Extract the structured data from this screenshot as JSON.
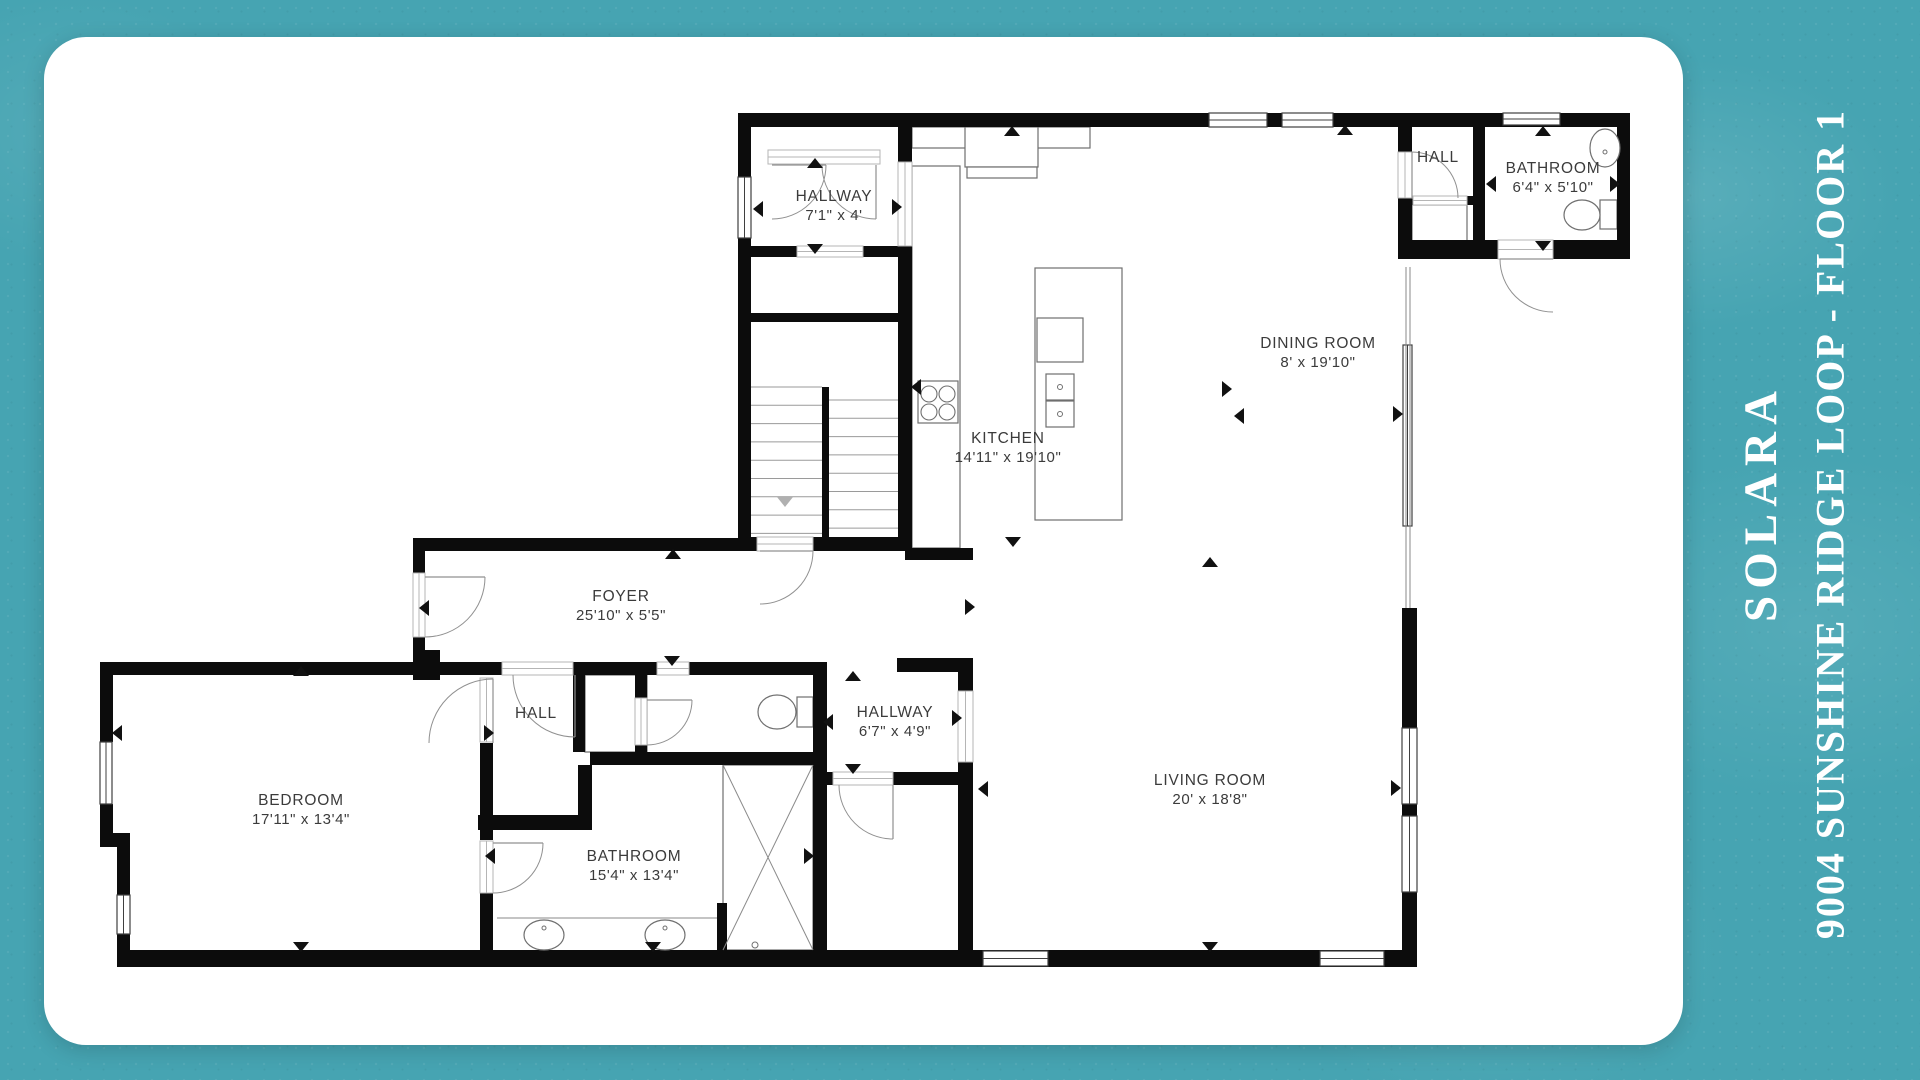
{
  "side_panel": {
    "title": "SOLARA",
    "subtitle": "9004 SUNSHINE RIDGE LOOP  - FLOOR 1"
  },
  "colors": {
    "background_teal": "#46a4b2",
    "card_white": "#ffffff",
    "wall_black": "#0c0c0c",
    "label_gray": "#3b3b3b",
    "title_white": "#ffffff"
  },
  "floor_plan": {
    "rooms": [
      {
        "id": "hallway-upper",
        "name": "HALLWAY",
        "dims": "7'1\" x 4'",
        "x": 834,
        "y": 201
      },
      {
        "id": "kitchen",
        "name": "KITCHEN",
        "dims": "14'11\" x 19'10\"",
        "x": 1008,
        "y": 443
      },
      {
        "id": "dining-room",
        "name": "DINING ROOM",
        "dims": "8' x 19'10\"",
        "x": 1318,
        "y": 348
      },
      {
        "id": "hall-top-right",
        "name": "HALL",
        "dims": "",
        "x": 1438,
        "y": 162
      },
      {
        "id": "bathroom-top-right",
        "name": "BATHROOM",
        "dims": "6'4\" x 5'10\"",
        "x": 1553,
        "y": 173
      },
      {
        "id": "foyer",
        "name": "FOYER",
        "dims": "25'10\" x 5'5\"",
        "x": 621,
        "y": 601
      },
      {
        "id": "bedroom",
        "name": "BEDROOM",
        "dims": "17'11\" x 13'4\"",
        "x": 301,
        "y": 805
      },
      {
        "id": "hall-lower",
        "name": "HALL",
        "dims": "",
        "x": 536,
        "y": 718
      },
      {
        "id": "bathroom-lower",
        "name": "BATHROOM",
        "dims": "15'4\" x 13'4\"",
        "x": 634,
        "y": 861
      },
      {
        "id": "hallway-lower",
        "name": "HALLWAY",
        "dims": "6'7\" x 4'9\"",
        "x": 895,
        "y": 717
      },
      {
        "id": "living-room",
        "name": "LIVING ROOM",
        "dims": "20' x 18'8\"",
        "x": 1210,
        "y": 785
      }
    ],
    "walls": [
      [
        738,
        113,
        892,
        14
      ],
      [
        738,
        127,
        13,
        420
      ],
      [
        898,
        127,
        14,
        35
      ],
      [
        898,
        246,
        14,
        302
      ],
      [
        738,
        246,
        174,
        11
      ],
      [
        750,
        313,
        153,
        9
      ],
      [
        738,
        537,
        174,
        14
      ],
      [
        905,
        548,
        68,
        12
      ],
      [
        413,
        538,
        340,
        13
      ],
      [
        413,
        551,
        12,
        111
      ],
      [
        413,
        650,
        27,
        30
      ],
      [
        1398,
        127,
        14,
        120
      ],
      [
        1473,
        127,
        12,
        116
      ],
      [
        1398,
        196,
        75,
        9
      ],
      [
        1617,
        127,
        13,
        120
      ],
      [
        1398,
        240,
        232,
        19
      ],
      [
        1402,
        608,
        15,
        120
      ],
      [
        1402,
        804,
        15,
        12
      ],
      [
        1402,
        892,
        15,
        75
      ],
      [
        117,
        950,
        1300,
        17
      ],
      [
        100,
        662,
        317,
        13
      ],
      [
        100,
        675,
        13,
        67
      ],
      [
        100,
        804,
        13,
        43
      ],
      [
        100,
        833,
        30,
        14
      ],
      [
        117,
        847,
        13,
        48
      ],
      [
        117,
        934,
        13,
        29
      ],
      [
        480,
        743,
        13,
        97
      ],
      [
        480,
        893,
        13,
        57
      ],
      [
        425,
        662,
        77,
        13
      ],
      [
        573,
        662,
        84,
        13
      ],
      [
        689,
        662,
        138,
        13
      ],
      [
        897,
        658,
        76,
        14
      ],
      [
        573,
        675,
        12,
        77
      ],
      [
        635,
        675,
        12,
        77
      ],
      [
        590,
        752,
        237,
        13
      ],
      [
        578,
        765,
        14,
        65
      ],
      [
        478,
        815,
        114,
        15
      ],
      [
        813,
        663,
        14,
        287
      ],
      [
        827,
        772,
        131,
        13
      ],
      [
        958,
        658,
        15,
        292
      ],
      [
        717,
        903,
        10,
        47
      ]
    ],
    "gaps": [
      [
        768,
        150,
        112,
        14
      ],
      [
        898,
        162,
        14,
        84
      ],
      [
        797,
        246,
        66,
        11
      ],
      [
        757,
        537,
        56,
        14
      ],
      [
        413,
        573,
        12,
        64
      ],
      [
        502,
        662,
        71,
        13
      ],
      [
        657,
        662,
        32,
        13
      ],
      [
        635,
        698,
        12,
        47
      ],
      [
        480,
        678,
        13,
        64
      ],
      [
        480,
        841,
        13,
        52
      ],
      [
        833,
        772,
        60,
        13
      ],
      [
        958,
        691,
        15,
        71
      ],
      [
        1398,
        152,
        14,
        46
      ],
      [
        1413,
        196,
        54,
        9
      ],
      [
        1498,
        240,
        55,
        19
      ]
    ],
    "windows": [
      [
        1209,
        113,
        58,
        14
      ],
      [
        1282,
        113,
        51,
        14
      ],
      [
        1503,
        113,
        57,
        12
      ],
      [
        738,
        177,
        13,
        61
      ],
      [
        100,
        742,
        12,
        62
      ],
      [
        117,
        895,
        13,
        39
      ],
      [
        1402,
        728,
        15,
        76
      ],
      [
        1402,
        816,
        15,
        76
      ],
      [
        983,
        951,
        65,
        15
      ],
      [
        1320,
        951,
        64,
        15
      ],
      [
        1403,
        345,
        9,
        181
      ]
    ],
    "outlines": [
      [
        912,
        127,
        178,
        21
      ],
      [
        965,
        127,
        73,
        40
      ],
      [
        967,
        167,
        70,
        11
      ],
      [
        912,
        166,
        48,
        382
      ],
      [
        918,
        381,
        40,
        42
      ],
      [
        1035,
        268,
        87,
        252
      ],
      [
        1037,
        318,
        46,
        44
      ],
      [
        1046,
        374,
        28,
        26
      ],
      [
        1046,
        401,
        28,
        26
      ],
      [
        723,
        765,
        90,
        185
      ],
      [
        585,
        675,
        62,
        77
      ],
      [
        1412,
        205,
        55,
        42
      ],
      [
        797,
        697,
        16,
        30
      ],
      [
        1600,
        200,
        17,
        29
      ]
    ],
    "lines": [
      [
        1406,
        267,
        1406,
        608
      ],
      [
        1410,
        267,
        1410,
        608
      ],
      [
        723,
        765,
        813,
        950
      ],
      [
        813,
        765,
        723,
        950
      ],
      [
        497,
        918,
        717,
        918
      ]
    ],
    "circles": [
      [
        929,
        394,
        8
      ],
      [
        947,
        394,
        8
      ],
      [
        929,
        412,
        8
      ],
      [
        947,
        412,
        8
      ]
    ],
    "ellipses": [
      [
        1605,
        148,
        15,
        19
      ],
      [
        1582,
        215,
        18,
        15
      ],
      [
        777,
        712,
        19,
        17
      ],
      [
        544,
        935,
        20,
        15
      ],
      [
        665,
        935,
        20,
        15
      ]
    ],
    "dots": [
      [
        544,
        928,
        2
      ],
      [
        665,
        928,
        2
      ],
      [
        1060,
        387,
        2.5
      ],
      [
        1060,
        414,
        2.5
      ],
      [
        1605,
        152,
        2
      ],
      [
        755,
        945,
        3
      ]
    ],
    "doors": [
      [
        772,
        165,
        54,
        0,
        90
      ],
      [
        876,
        165,
        54,
        90,
        180
      ],
      [
        1412,
        198,
        46,
        -90,
        0
      ],
      [
        1553,
        259,
        53,
        180,
        90
      ],
      [
        760,
        551,
        53,
        0,
        90
      ],
      [
        425,
        577,
        60,
        0,
        90
      ],
      [
        575,
        675,
        62,
        90,
        180
      ],
      [
        647,
        700,
        45,
        0,
        90
      ],
      [
        493,
        743,
        64,
        -90,
        -180
      ],
      [
        493,
        843,
        50,
        0,
        90
      ],
      [
        893,
        785,
        54,
        90,
        180
      ]
    ],
    "stairs": {
      "left": {
        "x1": 750,
        "x2": 822,
        "y0": 387,
        "step": 18.3,
        "n": 9
      },
      "right": {
        "x1": 829,
        "x2": 898,
        "y0": 400,
        "step": 18.3,
        "n": 8
      },
      "rail": [
        822,
        387,
        7,
        150
      ]
    },
    "arrows": [
      [
        815,
        163,
        "up"
      ],
      [
        815,
        249,
        "down"
      ],
      [
        758,
        209,
        "left"
      ],
      [
        897,
        207,
        "right"
      ],
      [
        1012,
        131,
        "up"
      ],
      [
        1345,
        130,
        "up"
      ],
      [
        1227,
        389,
        "right"
      ],
      [
        1239,
        416,
        "left"
      ],
      [
        916,
        387,
        "left"
      ],
      [
        1398,
        414,
        "right"
      ],
      [
        1543,
        131,
        "up"
      ],
      [
        1491,
        184,
        "left"
      ],
      [
        1615,
        184,
        "right"
      ],
      [
        1543,
        246,
        "down"
      ],
      [
        673,
        554,
        "up"
      ],
      [
        672,
        661,
        "down"
      ],
      [
        1013,
        542,
        "down"
      ],
      [
        1210,
        562,
        "up"
      ],
      [
        1210,
        947,
        "down"
      ],
      [
        983,
        789,
        "left"
      ],
      [
        1396,
        788,
        "right"
      ],
      [
        970,
        607,
        "right"
      ],
      [
        301,
        671,
        "up"
      ],
      [
        301,
        947,
        "down"
      ],
      [
        117,
        733,
        "left"
      ],
      [
        489,
        733,
        "right"
      ],
      [
        490,
        856,
        "left"
      ],
      [
        809,
        856,
        "right"
      ],
      [
        653,
        947,
        "down"
      ],
      [
        853,
        676,
        "up"
      ],
      [
        828,
        722,
        "left"
      ],
      [
        853,
        769,
        "down"
      ],
      [
        957,
        718,
        "right"
      ],
      [
        424,
        608,
        "left"
      ]
    ],
    "arrows_gray": [
      [
        785,
        502,
        "down"
      ]
    ]
  }
}
